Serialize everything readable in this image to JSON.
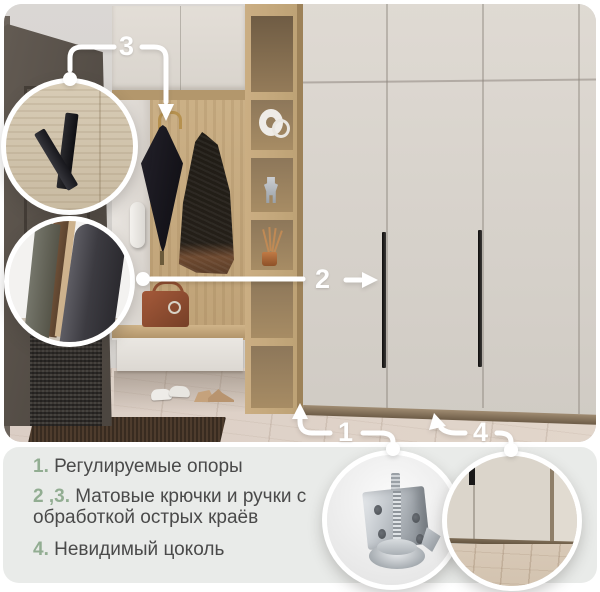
{
  "annotations": {
    "n1": {
      "label": "1"
    },
    "n2": {
      "label": "2"
    },
    "n3": {
      "label": "3"
    },
    "n4": {
      "label": "4"
    }
  },
  "legend": {
    "items": [
      {
        "num": "1.",
        "text": "Регулируемые опоры"
      },
      {
        "num": "2 ,3.",
        "text": "Матовые крючки и ручки с обработкой острых краёв"
      },
      {
        "num": "4.",
        "text": "Невидимый цоколь"
      }
    ]
  },
  "colors": {
    "accent_green": "#92ad92",
    "legend_text": "#4a4a4a",
    "legend_background": "#e9ebe9",
    "callout_white": "#ffffff",
    "wardrobe_cream": "#d8d3cc",
    "oak_wood": "#c6ab81",
    "door_dark": "#57504a"
  }
}
